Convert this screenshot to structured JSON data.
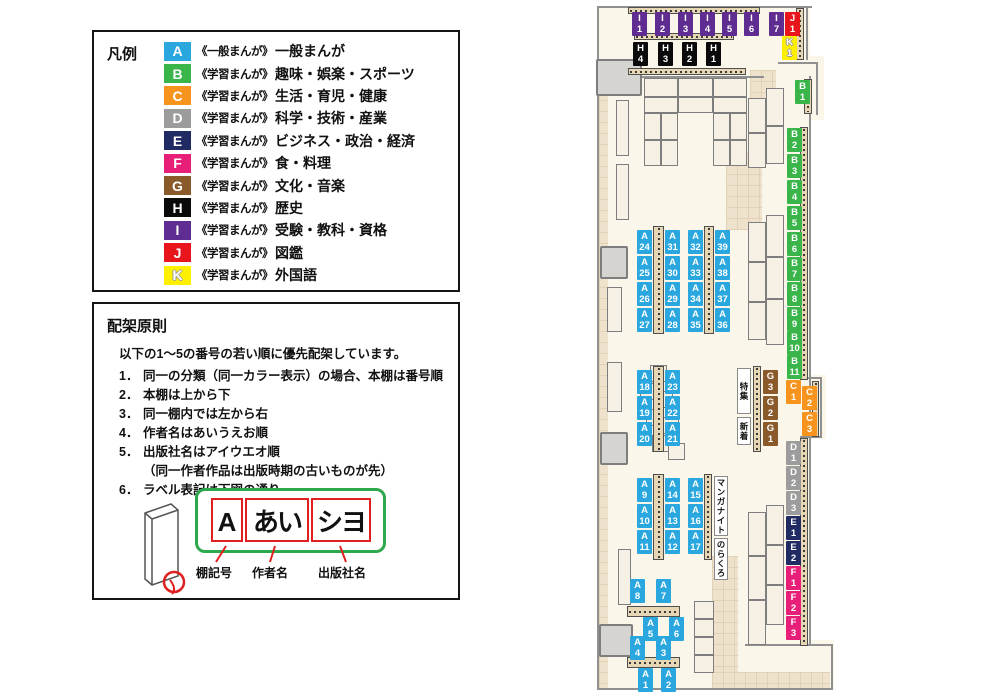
{
  "legend": {
    "title": "凡例",
    "items": [
      {
        "code": "A",
        "color": "#2BA7DF",
        "prefix": "《一般まんが》",
        "label": "一般まんが"
      },
      {
        "code": "B",
        "color": "#3AB54A",
        "prefix": "《学習まんが》",
        "label": "趣味・娯楽・スポーツ"
      },
      {
        "code": "C",
        "color": "#F7941D",
        "prefix": "《学習まんが》",
        "label": "生活・育児・健康"
      },
      {
        "code": "D",
        "color": "#9C9C9C",
        "prefix": "《学習まんが》",
        "label": "科学・技術・産業"
      },
      {
        "code": "E",
        "color": "#202A63",
        "prefix": "《学習まんが》",
        "label": "ビジネス・政治・経済"
      },
      {
        "code": "F",
        "color": "#E81F78",
        "prefix": "《学習まんが》",
        "label": "食・料理"
      },
      {
        "code": "G",
        "color": "#8B5A2B",
        "prefix": "《学習まんが》",
        "label": "文化・音楽"
      },
      {
        "code": "H",
        "color": "#0A0A0A",
        "prefix": "《学習まんが》",
        "label": "歴史"
      },
      {
        "code": "I",
        "color": "#5F2C91",
        "prefix": "《学習まんが》",
        "label": "受験・教科・資格"
      },
      {
        "code": "J",
        "color": "#E8151D",
        "prefix": "《学習まんが》",
        "label": "図鑑"
      },
      {
        "code": "K",
        "color": "#FFF000",
        "prefix": "《学習まんが》",
        "label": "外国語"
      }
    ]
  },
  "principles": {
    "title": "配架原則",
    "intro": "以下の1～5の番号の若い順に優先配架しています。",
    "rules": [
      {
        "num": "1．",
        "text": "同一の分類（同一カラー表示）の場合、本棚は番号順"
      },
      {
        "num": "2．",
        "text": "本棚は上から下"
      },
      {
        "num": "3．",
        "text": "同一棚内では左から右"
      },
      {
        "num": "4．",
        "text": "作者名はあいうえお順"
      },
      {
        "num": "5．",
        "text": "出版社名はアイウエオ順",
        "note": "（同一作者作品は出版時期の古いものが先）"
      },
      {
        "num": "6．",
        "text": "ラベル表記は下図の通り"
      }
    ],
    "label_example": {
      "shelf": "A",
      "author": "あい",
      "publisher": "シヨ",
      "captions": [
        "棚記号",
        "作者名",
        "出版社名"
      ]
    }
  },
  "map": {
    "category_colors": {
      "A": "#2BA7DF",
      "B": "#3AB54A",
      "C": "#F7941D",
      "D": "#9C9C9C",
      "E": "#202A63",
      "F": "#E81F78",
      "G": "#8B5A2B",
      "H": "#0A0A0A",
      "I": "#5F2C91",
      "J": "#E8151D",
      "K": "#FFF000"
    },
    "shelf_labels": [
      {
        "t": "I",
        "n": "1",
        "cat": "I",
        "x": 632,
        "y": 12
      },
      {
        "t": "I",
        "n": "2",
        "cat": "I",
        "x": 655,
        "y": 12
      },
      {
        "t": "I",
        "n": "3",
        "cat": "I",
        "x": 678,
        "y": 12
      },
      {
        "t": "I",
        "n": "4",
        "cat": "I",
        "x": 700,
        "y": 12
      },
      {
        "t": "I",
        "n": "5",
        "cat": "I",
        "x": 722,
        "y": 12
      },
      {
        "t": "I",
        "n": "6",
        "cat": "I",
        "x": 744,
        "y": 12
      },
      {
        "t": "I",
        "n": "7",
        "cat": "I",
        "x": 769,
        "y": 12
      },
      {
        "t": "J",
        "n": "1",
        "cat": "J",
        "x": 785,
        "y": 12
      },
      {
        "t": "K",
        "n": "1",
        "cat": "K",
        "x": 782,
        "y": 36
      },
      {
        "t": "H",
        "n": "4",
        "cat": "H",
        "x": 633,
        "y": 42
      },
      {
        "t": "H",
        "n": "3",
        "cat": "H",
        "x": 658,
        "y": 42
      },
      {
        "t": "H",
        "n": "2",
        "cat": "H",
        "x": 682,
        "y": 42
      },
      {
        "t": "H",
        "n": "1",
        "cat": "H",
        "x": 706,
        "y": 42
      },
      {
        "t": "B",
        "n": "1",
        "cat": "B",
        "x": 795,
        "y": 80
      },
      {
        "t": "B",
        "n": "2",
        "cat": "B",
        "x": 787,
        "y": 128
      },
      {
        "t": "B",
        "n": "3",
        "cat": "B",
        "x": 787,
        "y": 154
      },
      {
        "t": "B",
        "n": "4",
        "cat": "B",
        "x": 787,
        "y": 180
      },
      {
        "t": "B",
        "n": "5",
        "cat": "B",
        "x": 787,
        "y": 206
      },
      {
        "t": "B",
        "n": "6",
        "cat": "B",
        "x": 787,
        "y": 232
      },
      {
        "t": "B",
        "n": "7",
        "cat": "B",
        "x": 787,
        "y": 257
      },
      {
        "t": "B",
        "n": "8",
        "cat": "B",
        "x": 787,
        "y": 282
      },
      {
        "t": "B",
        "n": "9",
        "cat": "B",
        "x": 787,
        "y": 307
      },
      {
        "t": "B",
        "n": "10",
        "cat": "B",
        "x": 787,
        "y": 331
      },
      {
        "t": "B",
        "n": "11",
        "cat": "B",
        "x": 787,
        "y": 355
      },
      {
        "t": "C",
        "n": "1",
        "cat": "C",
        "x": 786,
        "y": 380
      },
      {
        "t": "C",
        "n": "2",
        "cat": "C",
        "x": 802,
        "y": 386
      },
      {
        "t": "C",
        "n": "3",
        "cat": "C",
        "x": 802,
        "y": 412
      },
      {
        "t": "D",
        "n": "1",
        "cat": "D",
        "x": 786,
        "y": 441
      },
      {
        "t": "D",
        "n": "2",
        "cat": "D",
        "x": 786,
        "y": 466
      },
      {
        "t": "D",
        "n": "3",
        "cat": "D",
        "x": 786,
        "y": 491
      },
      {
        "t": "E",
        "n": "1",
        "cat": "E",
        "x": 786,
        "y": 516
      },
      {
        "t": "E",
        "n": "2",
        "cat": "E",
        "x": 786,
        "y": 541
      },
      {
        "t": "F",
        "n": "1",
        "cat": "F",
        "x": 786,
        "y": 566
      },
      {
        "t": "F",
        "n": "2",
        "cat": "F",
        "x": 786,
        "y": 591
      },
      {
        "t": "F",
        "n": "3",
        "cat": "F",
        "x": 786,
        "y": 616
      },
      {
        "t": "A",
        "n": "24",
        "cat": "A",
        "x": 637,
        "y": 230
      },
      {
        "t": "A",
        "n": "31",
        "cat": "A",
        "x": 665,
        "y": 230
      },
      {
        "t": "A",
        "n": "32",
        "cat": "A",
        "x": 688,
        "y": 230
      },
      {
        "t": "A",
        "n": "39",
        "cat": "A",
        "x": 715,
        "y": 230
      },
      {
        "t": "A",
        "n": "25",
        "cat": "A",
        "x": 637,
        "y": 256
      },
      {
        "t": "A",
        "n": "30",
        "cat": "A",
        "x": 665,
        "y": 256
      },
      {
        "t": "A",
        "n": "33",
        "cat": "A",
        "x": 688,
        "y": 256
      },
      {
        "t": "A",
        "n": "38",
        "cat": "A",
        "x": 715,
        "y": 256
      },
      {
        "t": "A",
        "n": "26",
        "cat": "A",
        "x": 637,
        "y": 282
      },
      {
        "t": "A",
        "n": "29",
        "cat": "A",
        "x": 665,
        "y": 282
      },
      {
        "t": "A",
        "n": "34",
        "cat": "A",
        "x": 688,
        "y": 282
      },
      {
        "t": "A",
        "n": "37",
        "cat": "A",
        "x": 715,
        "y": 282
      },
      {
        "t": "A",
        "n": "27",
        "cat": "A",
        "x": 637,
        "y": 308
      },
      {
        "t": "A",
        "n": "28",
        "cat": "A",
        "x": 665,
        "y": 308
      },
      {
        "t": "A",
        "n": "35",
        "cat": "A",
        "x": 688,
        "y": 308
      },
      {
        "t": "A",
        "n": "36",
        "cat": "A",
        "x": 715,
        "y": 308
      },
      {
        "t": "A",
        "n": "18",
        "cat": "A",
        "x": 637,
        "y": 370
      },
      {
        "t": "A",
        "n": "23",
        "cat": "A",
        "x": 665,
        "y": 370
      },
      {
        "t": "A",
        "n": "19",
        "cat": "A",
        "x": 637,
        "y": 396
      },
      {
        "t": "A",
        "n": "22",
        "cat": "A",
        "x": 665,
        "y": 396
      },
      {
        "t": "A",
        "n": "20",
        "cat": "A",
        "x": 637,
        "y": 422
      },
      {
        "t": "A",
        "n": "21",
        "cat": "A",
        "x": 665,
        "y": 422
      },
      {
        "t": "G",
        "n": "3",
        "cat": "G",
        "x": 763,
        "y": 370
      },
      {
        "t": "G",
        "n": "2",
        "cat": "G",
        "x": 763,
        "y": 396
      },
      {
        "t": "G",
        "n": "1",
        "cat": "G",
        "x": 763,
        "y": 422
      },
      {
        "t": "A",
        "n": "9",
        "cat": "A",
        "x": 637,
        "y": 478
      },
      {
        "t": "A",
        "n": "14",
        "cat": "A",
        "x": 665,
        "y": 478
      },
      {
        "t": "A",
        "n": "10",
        "cat": "A",
        "x": 637,
        "y": 504
      },
      {
        "t": "A",
        "n": "13",
        "cat": "A",
        "x": 665,
        "y": 504
      },
      {
        "t": "A",
        "n": "11",
        "cat": "A",
        "x": 637,
        "y": 530
      },
      {
        "t": "A",
        "n": "12",
        "cat": "A",
        "x": 665,
        "y": 530
      },
      {
        "t": "A",
        "n": "15",
        "cat": "A",
        "x": 688,
        "y": 478
      },
      {
        "t": "A",
        "n": "16",
        "cat": "A",
        "x": 688,
        "y": 504
      },
      {
        "t": "A",
        "n": "17",
        "cat": "A",
        "x": 688,
        "y": 530
      },
      {
        "t": "A",
        "n": "8",
        "cat": "A",
        "x": 630,
        "y": 579
      },
      {
        "t": "A",
        "n": "7",
        "cat": "A",
        "x": 656,
        "y": 579
      },
      {
        "t": "A",
        "n": "5",
        "cat": "A",
        "x": 643,
        "y": 617
      },
      {
        "t": "A",
        "n": "6",
        "cat": "A",
        "x": 669,
        "y": 617
      },
      {
        "t": "A",
        "n": "4",
        "cat": "A",
        "x": 630,
        "y": 636
      },
      {
        "t": "A",
        "n": "3",
        "cat": "A",
        "x": 656,
        "y": 636
      },
      {
        "t": "A",
        "n": "1",
        "cat": "A",
        "x": 638,
        "y": 668
      },
      {
        "t": "A",
        "n": "2",
        "cat": "A",
        "x": 661,
        "y": 668
      }
    ],
    "area_labels": [
      {
        "text": "特集",
        "x": 737,
        "y": 368,
        "h": 46
      },
      {
        "text": "新着",
        "x": 737,
        "y": 417,
        "h": 28
      },
      {
        "text": "マンガナイト",
        "x": 714,
        "y": 476,
        "h": 60
      },
      {
        "text": "のらくろ",
        "x": 714,
        "y": 538,
        "h": 42
      }
    ]
  }
}
